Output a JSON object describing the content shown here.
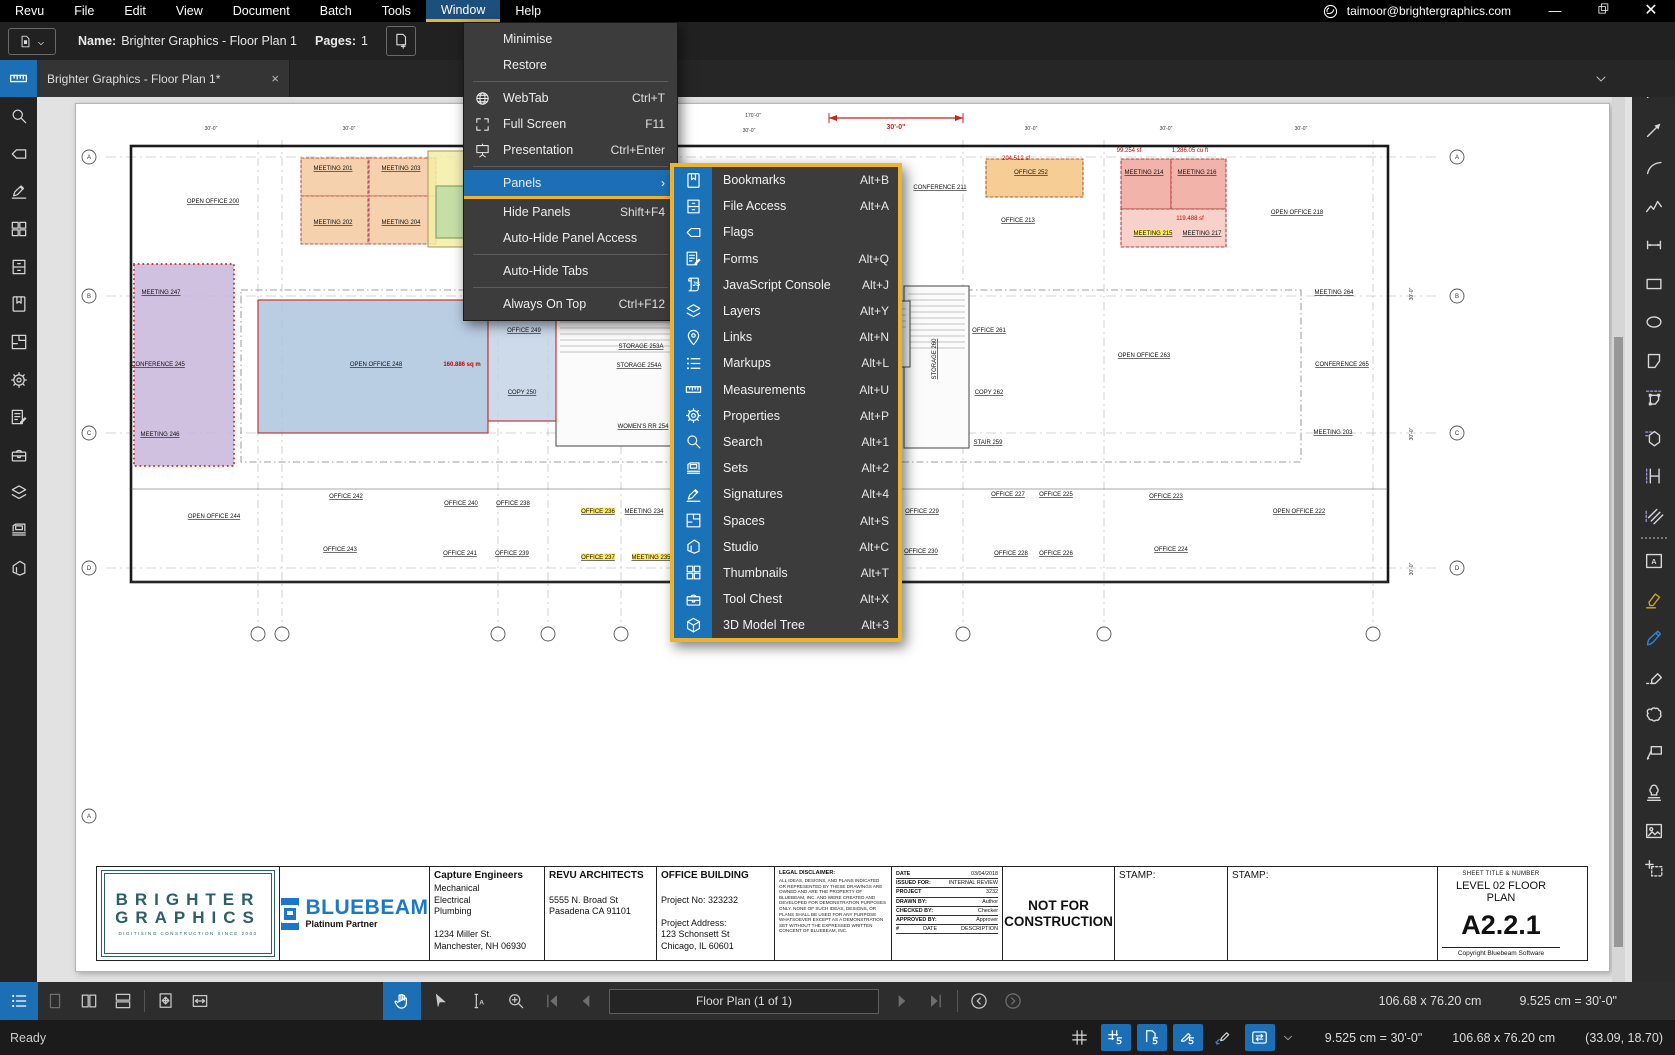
{
  "titlebar": {
    "menus": [
      "Revu",
      "File",
      "Edit",
      "View",
      "Document",
      "Batch",
      "Tools",
      "Window",
      "Help"
    ],
    "active_menu": "Window",
    "account_email": "taimoor@brightergraphics.com",
    "accent_yellow": "#edb32f",
    "accent_blue": "#1d6fb5"
  },
  "docbar": {
    "name_label": "Name:",
    "name_value": "Brighter Graphics - Floor Plan 1",
    "pages_label": "Pages:",
    "pages_value": "1"
  },
  "tabbar": {
    "tab_title": "Brighter Graphics - Floor Plan 1*",
    "close_glyph": "×"
  },
  "window_menu": {
    "items": [
      {
        "label": "Minimise",
        "shortcut": "",
        "icon": ""
      },
      {
        "label": "Restore",
        "shortcut": "",
        "icon": "",
        "divider_after": true
      },
      {
        "label": "WebTab",
        "shortcut": "Ctrl+T",
        "icon": "globe"
      },
      {
        "label": "Full Screen",
        "shortcut": "F11",
        "icon": "fullscreen"
      },
      {
        "label": "Presentation",
        "shortcut": "Ctrl+Enter",
        "icon": "presentation",
        "divider_after": true
      },
      {
        "label": "Panels",
        "shortcut": "",
        "icon": "",
        "submenu": true,
        "active": true
      },
      {
        "label": "Hide Panels",
        "shortcut": "Shift+F4",
        "icon": ""
      },
      {
        "label": "Auto-Hide Panel Access",
        "shortcut": "",
        "icon": "",
        "divider_after": true
      },
      {
        "label": "Auto-Hide Tabs",
        "shortcut": "",
        "icon": "",
        "divider_after": true
      },
      {
        "label": "Always On Top",
        "shortcut": "Ctrl+F12",
        "icon": ""
      }
    ]
  },
  "panels_submenu": {
    "items": [
      {
        "label": "Bookmarks",
        "shortcut": "Alt+B",
        "icon": "bookmark"
      },
      {
        "label": "File Access",
        "shortcut": "Alt+A",
        "icon": "fileaccess"
      },
      {
        "label": "Flags",
        "shortcut": "",
        "icon": "flag"
      },
      {
        "label": "Forms",
        "shortcut": "Alt+Q",
        "icon": "forms"
      },
      {
        "label": "JavaScript Console",
        "shortcut": "Alt+J",
        "icon": "js"
      },
      {
        "label": "Layers",
        "shortcut": "Alt+Y",
        "icon": "layers"
      },
      {
        "label": "Links",
        "shortcut": "Alt+N",
        "icon": "links"
      },
      {
        "label": "Markups",
        "shortcut": "Alt+L",
        "icon": "markups"
      },
      {
        "label": "Measurements",
        "shortcut": "Alt+U",
        "icon": "measurements"
      },
      {
        "label": "Properties",
        "shortcut": "Alt+P",
        "icon": "gear"
      },
      {
        "label": "Search",
        "shortcut": "Alt+1",
        "icon": "search"
      },
      {
        "label": "Sets",
        "shortcut": "Alt+2",
        "icon": "sets"
      },
      {
        "label": "Signatures",
        "shortcut": "Alt+4",
        "icon": "signatures"
      },
      {
        "label": "Spaces",
        "shortcut": "Alt+S",
        "icon": "spaces"
      },
      {
        "label": "Studio",
        "shortcut": "Alt+C",
        "icon": "studio"
      },
      {
        "label": "Thumbnails",
        "shortcut": "Alt+T",
        "icon": "thumbnails"
      },
      {
        "label": "Tool Chest",
        "shortcut": "Alt+X",
        "icon": "toolchest"
      },
      {
        "label": "3D Model Tree",
        "shortcut": "Alt+3",
        "icon": "cube3d"
      }
    ]
  },
  "left_sidebar": {
    "active_icon": "measurements",
    "icons": [
      "search",
      "flag",
      "signatures",
      "thumbnails",
      "fileaccess",
      "bookmark",
      "spaces",
      "gear",
      "forms",
      "toolchest",
      "layers",
      "sets",
      "studio"
    ]
  },
  "right_toolbar": {
    "items": [
      {
        "icon": "divider"
      },
      {
        "icon": "line"
      },
      {
        "icon": "arrow"
      },
      {
        "icon": "arc"
      },
      {
        "icon": "polyline"
      },
      {
        "icon": "dimlen"
      },
      {
        "icon": "rect"
      },
      {
        "icon": "ellipse"
      },
      {
        "icon": "polygon"
      },
      {
        "icon": "polymeasure"
      },
      {
        "icon": "area"
      },
      {
        "icon": "caliper"
      },
      {
        "icon": "hatch"
      },
      {
        "icon": "divider"
      },
      {
        "icon": "textbox"
      },
      {
        "icon": "highlighter",
        "cls": "rt-yellow"
      },
      {
        "icon": "pen",
        "cls": "rt-blue"
      },
      {
        "icon": "eraser"
      },
      {
        "icon": "cloud"
      },
      {
        "icon": "callout"
      },
      {
        "icon": "stamp"
      },
      {
        "icon": "imageic"
      },
      {
        "icon": "snapshot"
      }
    ]
  },
  "navbar": {
    "left_icons": [
      "markuplist",
      "pg1",
      "pg2col",
      "pgrows",
      "sep",
      "pgmove",
      "fitwidth"
    ],
    "center_icons": [
      "hand",
      "cursor",
      "textselect",
      "zoomin"
    ],
    "page_field": "Floor Plan (1 of 1)",
    "doc_size": "106.68 x 76.20 cm",
    "scale": "9.525 cm = 30'-0\""
  },
  "status_bar": {
    "status": "Ready",
    "icons": [
      "hash",
      "snapgrid",
      "snapdoc",
      "snapmarkup",
      "reuse",
      "sync"
    ],
    "boxed": [
      "snapgrid",
      "snapdoc",
      "snapmarkup",
      "sync"
    ],
    "scale": "9.525 cm = 30'-0\"",
    "size": "106.68 x 76.20 cm",
    "coords": "(33.09, 18.70)"
  },
  "floor_plan": {
    "building": {
      "x": 55,
      "y": 42,
      "w": 1257,
      "h": 436
    },
    "corridor": {
      "x": 165,
      "y": 186,
      "w": 1060,
      "h": 172
    },
    "cores": [
      {
        "x": 480,
        "y": 186,
        "w": 118,
        "h": 156
      },
      {
        "x": 828,
        "y": 182,
        "w": 65,
        "h": 162
      },
      {
        "x": 818,
        "y": 197,
        "w": 16,
        "h": 66
      }
    ],
    "hlines": [
      53,
      192,
      329,
      464
    ],
    "vlines": [
      182,
      206,
      422,
      472,
      545,
      887,
      1028,
      1297
    ],
    "bubbles": [
      {
        "x": 13,
        "y": 53,
        "t": "A"
      },
      {
        "x": 13,
        "y": 192,
        "t": "B"
      },
      {
        "x": 13,
        "y": 329,
        "t": "C"
      },
      {
        "x": 13,
        "y": 464,
        "t": "D"
      },
      {
        "x": 1381,
        "y": 53,
        "t": "A"
      },
      {
        "x": 1381,
        "y": 192,
        "t": "B"
      },
      {
        "x": 1381,
        "y": 329,
        "t": "C"
      },
      {
        "x": 1381,
        "y": 464,
        "t": "D"
      },
      {
        "x": 182,
        "y": 530,
        "t": ""
      },
      {
        "x": 206,
        "y": 530,
        "t": ""
      },
      {
        "x": 422,
        "y": 530,
        "t": ""
      },
      {
        "x": 472,
        "y": 530,
        "t": ""
      },
      {
        "x": 545,
        "y": 530,
        "t": ""
      },
      {
        "x": 887,
        "y": 530,
        "t": ""
      },
      {
        "x": 1028,
        "y": 530,
        "t": ""
      },
      {
        "x": 1297,
        "y": 530,
        "t": ""
      },
      {
        "x": 13,
        "y": 712,
        "t": "A"
      }
    ],
    "rooms": [
      {
        "x": 225,
        "y": 54,
        "w": 67,
        "h": 38,
        "f": "#f4c9a0",
        "s": "#c05555",
        "dash": true
      },
      {
        "x": 293,
        "y": 54,
        "w": 67,
        "h": 38,
        "f": "#f4c9a0",
        "s": "#c05555",
        "dash": true
      },
      {
        "x": 225,
        "y": 92,
        "w": 67,
        "h": 48,
        "f": "#f4c9a0",
        "s": "#c05555",
        "dash": true
      },
      {
        "x": 293,
        "y": 92,
        "w": 67,
        "h": 48,
        "f": "#f4c9a0",
        "s": "#c05555",
        "dash": true
      },
      {
        "x": 352,
        "y": 47,
        "w": 44,
        "h": 96,
        "f": "#f4eda6",
        "s": "#a8a060"
      },
      {
        "x": 360,
        "y": 82,
        "w": 34,
        "h": 52,
        "f": "#bcdca4",
        "s": "#7da060"
      },
      {
        "x": 58,
        "y": 160,
        "w": 100,
        "h": 202,
        "f": "#c9b6dc",
        "s": "#cc3333",
        "scallop": true
      },
      {
        "x": 182,
        "y": 196,
        "w": 230,
        "h": 133,
        "f": "#adc6de",
        "s": "#cc2222"
      },
      {
        "x": 412,
        "y": 205,
        "w": 68,
        "h": 112,
        "f": "#c3d4e6",
        "s": "#cc2222"
      },
      {
        "x": 910,
        "y": 55,
        "w": 97,
        "h": 38,
        "f": "#f5c481",
        "s": "#b06030",
        "dash": true
      },
      {
        "x": 1045,
        "y": 55,
        "w": 50,
        "h": 50,
        "f": "#f0a69c",
        "s": "#b04040",
        "dash": true
      },
      {
        "x": 1095,
        "y": 55,
        "w": 55,
        "h": 50,
        "f": "#f0a69c",
        "s": "#b04040",
        "dash": true
      },
      {
        "x": 1045,
        "y": 105,
        "w": 105,
        "h": 38,
        "f": "#f6c9c1",
        "s": "#b04040",
        "dash": true
      }
    ],
    "labels": [
      {
        "t": "OPEN OFFICE 200",
        "x": 137,
        "y": 99
      },
      {
        "t": "MEETING 201",
        "x": 257,
        "y": 66
      },
      {
        "t": "MEETING 203",
        "x": 325,
        "y": 66
      },
      {
        "t": "MEETING 202",
        "x": 257,
        "y": 120
      },
      {
        "t": "MEETING 204",
        "x": 325,
        "y": 120
      },
      {
        "t": "MEETING 247",
        "x": 85,
        "y": 190
      },
      {
        "t": "CONFERENCE 245",
        "x": 82,
        "y": 262
      },
      {
        "t": "MEETING 246",
        "x": 84,
        "y": 332
      },
      {
        "t": "OPEN OFFICE 248",
        "x": 300,
        "y": 262
      },
      {
        "t": "160.886 sq m",
        "x": 386,
        "y": 262,
        "c": "#cc0000",
        "nu": true,
        "bold": true
      },
      {
        "t": "OFFICE 249",
        "x": 448,
        "y": 228
      },
      {
        "t": "COPY 250",
        "x": 446,
        "y": 290
      },
      {
        "t": "STAIR 251",
        "x": 504,
        "y": 207
      },
      {
        "t": "ELECTRICAL 253",
        "x": 562,
        "y": 207
      },
      {
        "t": "STORAGE 253A",
        "x": 565,
        "y": 244
      },
      {
        "t": "STORAGE 254A",
        "x": 563,
        "y": 263
      },
      {
        "t": "WOMEN'S RR 254",
        "x": 567,
        "y": 324
      },
      {
        "t": "OPEN OFFICE 244",
        "x": 138,
        "y": 414
      },
      {
        "t": "OFFICE 242",
        "x": 270,
        "y": 394
      },
      {
        "t": "OFFICE 243",
        "x": 264,
        "y": 447
      },
      {
        "t": "OFFICE 240",
        "x": 385,
        "y": 401
      },
      {
        "t": "OFFICE 238",
        "x": 437,
        "y": 401
      },
      {
        "t": "OFFICE 241",
        "x": 384,
        "y": 451
      },
      {
        "t": "OFFICE 239",
        "x": 436,
        "y": 451
      },
      {
        "t": "OFFICE 236",
        "x": 522,
        "y": 409,
        "hl": true
      },
      {
        "t": "MEETING 234",
        "x": 568,
        "y": 409
      },
      {
        "t": "OFFICE 237",
        "x": 522,
        "y": 455,
        "hl": true
      },
      {
        "t": "MEETING 235",
        "x": 575,
        "y": 455,
        "hl": true
      },
      {
        "t": "CONFERENCE 211",
        "x": 864,
        "y": 85
      },
      {
        "t": "OFFICE 213",
        "x": 942,
        "y": 118
      },
      {
        "t": "204.512 sf",
        "x": 940,
        "y": 56,
        "c": "#cc0000",
        "nu": true
      },
      {
        "t": "OFFICE 252",
        "x": 955,
        "y": 70
      },
      {
        "t": "OPEN OFFICE 218",
        "x": 1221,
        "y": 110
      },
      {
        "t": "99.254 sf",
        "x": 1053,
        "y": 48,
        "c": "#cc0000",
        "nu": true
      },
      {
        "t": "1,286.05 cu ft",
        "x": 1114,
        "y": 48,
        "c": "#cc0000",
        "nu": true
      },
      {
        "t": "MEETING 214",
        "x": 1068,
        "y": 70
      },
      {
        "t": "MEETING 216",
        "x": 1121,
        "y": 70
      },
      {
        "t": "119.488 sf",
        "x": 1114,
        "y": 116,
        "c": "#cc0000",
        "nu": true
      },
      {
        "t": "MEETING 215",
        "x": 1077,
        "y": 131,
        "hl": true
      },
      {
        "t": "MEETING 217",
        "x": 1126,
        "y": 131
      },
      {
        "t": "OFFICE 261",
        "x": 913,
        "y": 228
      },
      {
        "t": "OPEN OFFICE 263",
        "x": 1068,
        "y": 253
      },
      {
        "t": "COPY 262",
        "x": 913,
        "y": 290
      },
      {
        "t": "STAIR 259",
        "x": 912,
        "y": 340
      },
      {
        "t": "STORAGE 260",
        "x": 860,
        "y": 255,
        "rot": true
      },
      {
        "t": "MEETING 264",
        "x": 1258,
        "y": 190
      },
      {
        "t": "CONFERENCE 265",
        "x": 1266,
        "y": 262
      },
      {
        "t": "MEETING 203",
        "x": 1257,
        "y": 330
      },
      {
        "t": "OFFICE 227",
        "x": 932,
        "y": 392
      },
      {
        "t": "OFFICE 225",
        "x": 980,
        "y": 392
      },
      {
        "t": "OFFICE 223",
        "x": 1090,
        "y": 394
      },
      {
        "t": "OFFICE 229",
        "x": 846,
        "y": 409
      },
      {
        "t": "OFFICE 230",
        "x": 845,
        "y": 449
      },
      {
        "t": "OFFICE 228",
        "x": 935,
        "y": 451
      },
      {
        "t": "OFFICE 226",
        "x": 980,
        "y": 451
      },
      {
        "t": "OFFICE 224",
        "x": 1095,
        "y": 447
      },
      {
        "t": "OPEN OFFICE 222",
        "x": 1223,
        "y": 409
      },
      {
        "t": "30'-0\"",
        "x": 135,
        "y": 26,
        "c": "#333333",
        "nu": true,
        "dim": true
      },
      {
        "t": "30'-0\"",
        "x": 273,
        "y": 26,
        "c": "#333333",
        "nu": true,
        "dim": true
      },
      {
        "t": "170'-0\"",
        "x": 677,
        "y": 13,
        "c": "#333333",
        "nu": true,
        "dim": true
      },
      {
        "t": "30'-0\"",
        "x": 673,
        "y": 28,
        "c": "#333333",
        "nu": true,
        "dim": true
      },
      {
        "t": "30'-0\"",
        "x": 955,
        "y": 26,
        "c": "#333333",
        "nu": true,
        "dim": true
      },
      {
        "t": "30'-0\"",
        "x": 1090,
        "y": 26,
        "c": "#333333",
        "nu": true,
        "dim": true
      },
      {
        "t": "30'-0\"",
        "x": 1225,
        "y": 26,
        "c": "#333333",
        "nu": true,
        "dim": true
      },
      {
        "t": "30'-0\"",
        "x": 1337,
        "y": 190,
        "c": "#333333",
        "nu": true,
        "dim": true,
        "rot": true
      },
      {
        "t": "30'-0\"",
        "x": 1337,
        "y": 330,
        "c": "#333333",
        "nu": true,
        "dim": true,
        "rot": true
      },
      {
        "t": "30'-0\"",
        "x": 1337,
        "y": 465,
        "c": "#333333",
        "nu": true,
        "dim": true,
        "rot": true
      }
    ],
    "red_dimension": {
      "x1": 753,
      "x2": 887,
      "y": 14,
      "label": "30'-0\"",
      "lx": 820,
      "ly": 25,
      "color": "#cc2222"
    }
  },
  "title_block": {
    "columns": [
      {
        "type": "logo-brighter",
        "w": 183,
        "line1": "BRIGHTER",
        "line2": "GRAPHICS",
        "sub": "DIGITISING CONSTRUCTION SINCE 2003"
      },
      {
        "type": "logo-bluebeam",
        "w": 150,
        "word": "BLUEBEAM",
        "sub": "Platinum Partner"
      },
      {
        "type": "text",
        "w": 115,
        "title": "Capture Engineers",
        "lines": [
          "Mechanical",
          "Electrical",
          "Plumbing",
          "",
          "1234 Miller St.",
          "Manchester, NH 06930"
        ]
      },
      {
        "type": "text",
        "w": 112,
        "title": "REVU ARCHITECTS",
        "lines": [
          "",
          "5555 N. Broad St",
          "Pasadena CA 91101"
        ]
      },
      {
        "type": "text",
        "w": 118,
        "title": "OFFICE BUILDING",
        "lines": [
          "",
          "Project No: 323232",
          "",
          "Project Address:",
          "123 Schonsett St",
          "Chicago, IL 60601"
        ]
      },
      {
        "type": "legal",
        "w": 117,
        "title": "LEGAL DISCLAIMER:",
        "body": "ALL IDEAS, DESIGNS, AND PLANS INDICATED OR REPRESENTED BY THESE DRAWINGS ARE OWNED AND ARE THE PROPERTY OF BLUEBEAM, INC. AND WERE CREATED AND DEVELOPED FOR DEMONSTRATION PURPOSES ONLY. NONE OF SUCH IDEAS, DESIGNS, OR PLANS SHALL BE USED FOR ANY PURPOSE WHATSOEVER EXCEPT AS A DEMONSTRATION SET WITHOUT THE EXPRESSED WRITTEN CONCENT OF BLUEBEAM, INC."
      },
      {
        "type": "table",
        "w": 111,
        "rows": [
          [
            "DATE",
            "03/04/2018"
          ],
          [
            "ISSUED FOR:",
            "INTERNAL REVIEW"
          ],
          [
            "PROJECT",
            "3232"
          ],
          [
            "DRAWN BY:",
            "Author"
          ],
          [
            "CHECKED BY:",
            "Checker"
          ],
          [
            "APPROVED BY:",
            "Approver"
          ],
          [
            "#",
            "DATE",
            "DESCRIPTION"
          ]
        ]
      },
      {
        "type": "big",
        "w": 112,
        "text1": "NOT FOR",
        "text2": "CONSTRUCTION"
      },
      {
        "type": "stamp",
        "w": 113,
        "label": "STAMP:"
      },
      {
        "type": "stamp",
        "w": 210,
        "label": "STAMP:"
      },
      {
        "type": "sheet",
        "w": 126,
        "header": "SHEET TITLE & NUMBER",
        "title1": "LEVEL 02 FLOOR",
        "title2": "PLAN",
        "number": "A2.2.1",
        "footer": "Copyright Bluebeam Software"
      }
    ]
  }
}
